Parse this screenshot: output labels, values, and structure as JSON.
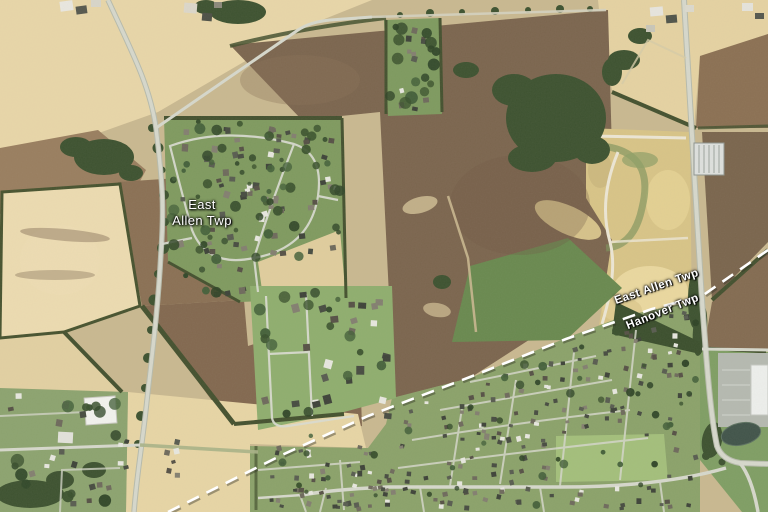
{
  "map": {
    "area_label": {
      "line1": "East",
      "line2": "Allen Twp"
    },
    "boundary": {
      "upper_label": "East Allen Twp",
      "lower_label": "Hanover Twp"
    }
  },
  "palette": {
    "label_text": "#ffffff",
    "label_halo": "#000000",
    "boundary_line": "#ffffff",
    "field_cream": "#e8d6a8",
    "field_brown": "#7b654e",
    "lawn_green": "#8ba26a",
    "woods_green": "#3d5230",
    "road_gray": "#d6d8cc",
    "construction_tan": "#d8c487",
    "pond_teal": "#41544a"
  }
}
